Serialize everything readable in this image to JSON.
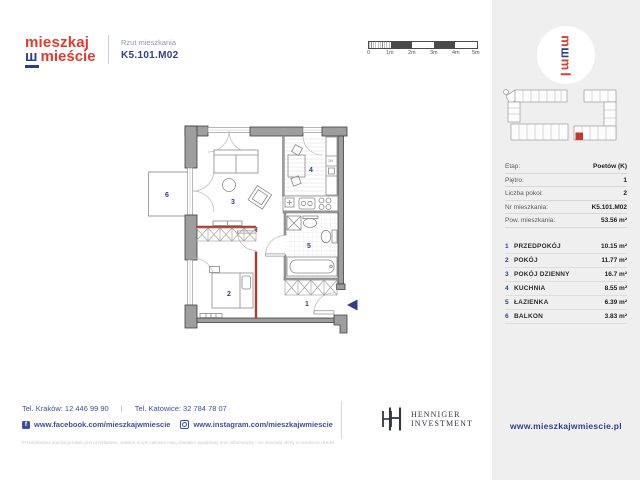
{
  "colors": {
    "brand_red": "#e23b2e",
    "brand_blue": "#2f3e92",
    "red_wall_accent": "#b03a2e",
    "sidebar_bg": "#efeff0",
    "wall_gray": "#9e9e9e"
  },
  "header": {
    "logo_line1": "mieszkaj",
    "logo_w": "ш",
    "logo_line2": "mieście",
    "subtitle": "Rzut mieszkania",
    "plan_id": "K5.101.M02"
  },
  "scalebar": {
    "labels": [
      "0",
      "1m",
      "2m",
      "3m",
      "4m",
      "5m"
    ]
  },
  "plan": {
    "labels": {
      "r1": "1",
      "r2": "2",
      "r3": "3",
      "r4": "4",
      "r5": "5",
      "r6": "6"
    },
    "appliance": "ZM"
  },
  "sidebar": {
    "monogram": {
      "m1": "m",
      "w": "ш",
      "m2": "m"
    },
    "details": [
      {
        "label": "Etap:",
        "value": "Poetów (K)"
      },
      {
        "label": "Piętro:",
        "value": "1"
      },
      {
        "label": "Liczba pokoi:",
        "value": "2"
      },
      {
        "label": "Nr mieszkania:",
        "value": "K5.101.M02"
      },
      {
        "label": "Pow. mieszkania:",
        "value": "53.56 m²"
      }
    ],
    "rooms": [
      {
        "num": "1",
        "name": "PRZEDPOKÓJ",
        "area": "10.15 m²"
      },
      {
        "num": "2",
        "name": "POKÓJ",
        "area": "11.77 m²"
      },
      {
        "num": "3",
        "name": "POKÓJ DZIENNY",
        "area": "16.7 m²"
      },
      {
        "num": "4",
        "name": "KUCHNIA",
        "area": "8.55 m²"
      },
      {
        "num": "5",
        "name": "ŁAZIENKA",
        "area": "6.39 m²"
      },
      {
        "num": "6",
        "name": "BALKON",
        "area": "3.83 m²"
      }
    ],
    "website": "www.mieszkajwmiescie.pl"
  },
  "footer": {
    "phone_krakow": "Tel. Kraków: 12 446 99 90",
    "phone_sep": "|",
    "phone_katowice": "Tel. Katowice: 32 784 78 07",
    "facebook_icon": "f",
    "facebook": "www.facebook.com/mieszkajwmiescie",
    "instagram": "www.instagram.com/mieszkajwmiescie",
    "disclaimer": "Przedstawiona aranżacja lokalu jest przykładowa, zawarte w tym zakresie mają charakter poglądowy oraz informacyjny i nie stanowią oferty w rozumieniu Kodeksu Cywilnego.",
    "developer_line1": "HENNIGER",
    "developer_line2": "INVESTMENT"
  }
}
